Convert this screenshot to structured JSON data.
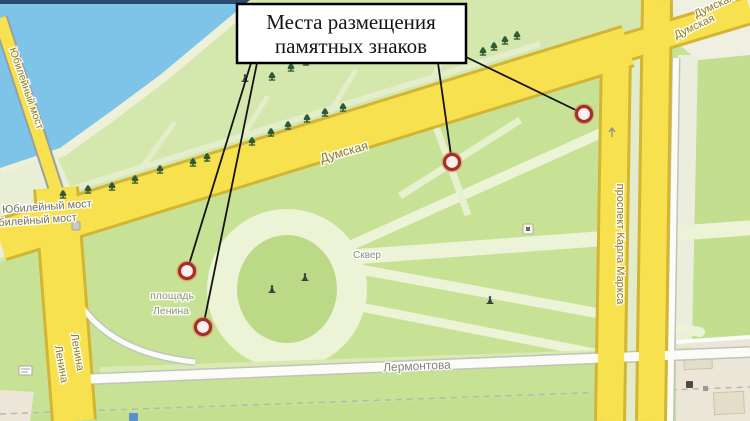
{
  "title_box": {
    "line1": "Места размещения",
    "line2": "памятных знаков"
  },
  "street_labels": {
    "dumskaya_main": "Думская",
    "dumskaya_upper": "Думская",
    "dumskaya_corner": "Думская",
    "karla_marksa": "проспект Карла Маркса",
    "lenina_1": "Ленина",
    "lenina_2": "Ленина",
    "lermontova": "Лермонтова",
    "bridge_on_road": "Юбилейный мост",
    "bridge_label_1": "Юбилейный мост",
    "bridge_label_2": "Юбилейный мост",
    "ploshchad_line1": "площадь",
    "ploshchad_line2": "Ленина",
    "skver": "Сквер"
  },
  "memorial_markers": [
    {
      "x": 187,
      "y": 271,
      "line_from": [
        251,
        63
      ]
    },
    {
      "x": 203,
      "y": 327,
      "line_from": [
        257,
        63
      ]
    },
    {
      "x": 452,
      "y": 162,
      "line_from": [
        438,
        63
      ]
    },
    {
      "x": 584,
      "y": 114,
      "line_from": [
        466,
        57
      ]
    }
  ],
  "map_icons": {
    "trees": [
      [
        63,
        195
      ],
      [
        88,
        190
      ],
      [
        112,
        187
      ],
      [
        135,
        180
      ],
      [
        160,
        170
      ],
      [
        193,
        163
      ],
      [
        207,
        158
      ],
      [
        252,
        142
      ],
      [
        271,
        133
      ],
      [
        288,
        126
      ],
      [
        307,
        119
      ],
      [
        325,
        113
      ],
      [
        343,
        108
      ],
      [
        272,
        77
      ],
      [
        291,
        68
      ],
      [
        306,
        62
      ],
      [
        483,
        52
      ],
      [
        494,
        47
      ],
      [
        505,
        41
      ],
      [
        517,
        36
      ]
    ],
    "monuments": [
      [
        272,
        289
      ],
      [
        305,
        277
      ],
      [
        490,
        300
      ],
      [
        245,
        78
      ]
    ]
  },
  "colors": {
    "water": "#7dc4e8",
    "park_green": "#c8e295",
    "embankment_green": "#d4e7ad",
    "road_yellow": "#f8e14e",
    "road_casing": "#d2b535",
    "marker_ring": "#a23228",
    "marker_fill": "#fcedee",
    "marker_glow": "#e07b4a",
    "callout_line": "#141414",
    "tree_green": "#2f5a33"
  }
}
